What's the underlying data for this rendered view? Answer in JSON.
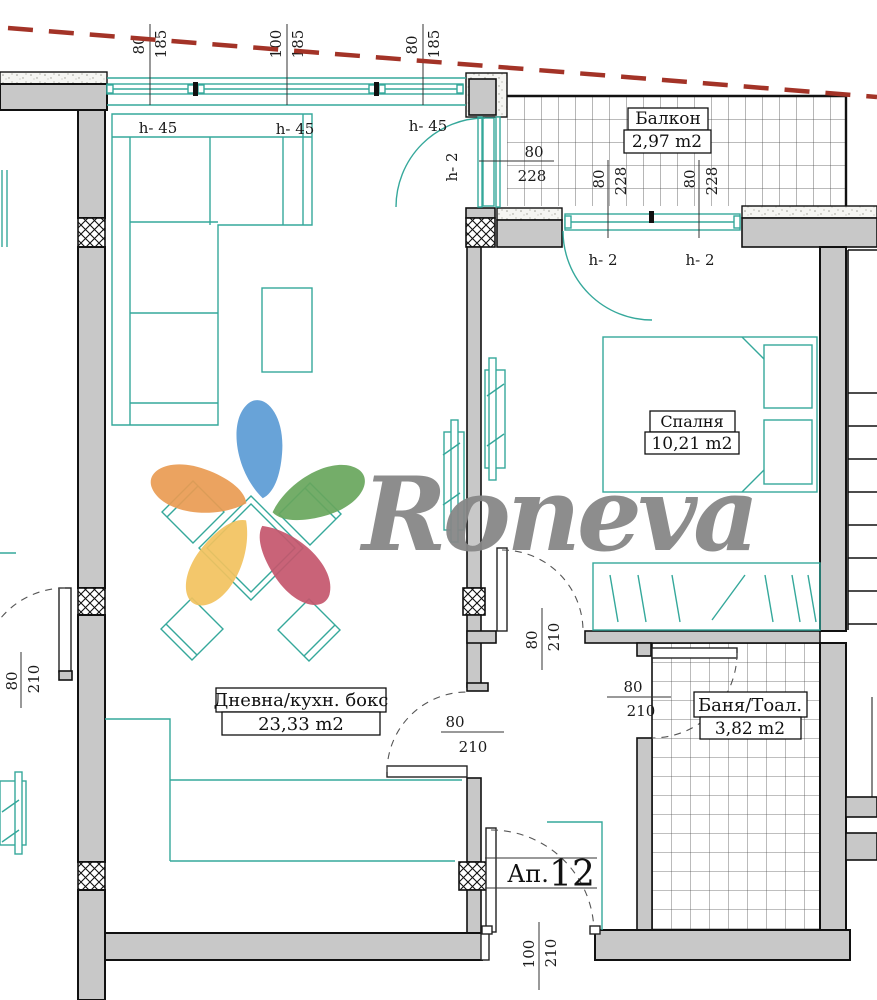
{
  "plan": {
    "apartment_label": {
      "prefix": "Ап.",
      "number": "12"
    },
    "rooms": {
      "balcony": {
        "name": "Балкон",
        "area": "2,97 m2"
      },
      "bedroom": {
        "name": "Спалня",
        "area": "10,21 m2"
      },
      "living": {
        "name": "Дневна/кухн. бокс",
        "area": "23,33 m2"
      },
      "bath": {
        "name": "Баня/Тоал.",
        "area": "3,82 m2"
      }
    },
    "height_labels": {
      "h45": "h- 45",
      "h2": "h- 2"
    },
    "dims": {
      "d80": "80",
      "d100": "100",
      "d185": "185",
      "d210": "210",
      "d228": "228"
    }
  },
  "watermark": {
    "brand": "Roneva"
  },
  "colors": {
    "furniture_teal": "#35a89b",
    "wall_gray": "#c8c8c8",
    "boundary_red": "#a33327",
    "logo_text_gray": "#878787",
    "logo_blue": "#5b9bd5",
    "logo_green": "#68a65c",
    "logo_rose": "#c4566d",
    "logo_yellow": "#f2c25e",
    "logo_orange": "#e99b52"
  }
}
